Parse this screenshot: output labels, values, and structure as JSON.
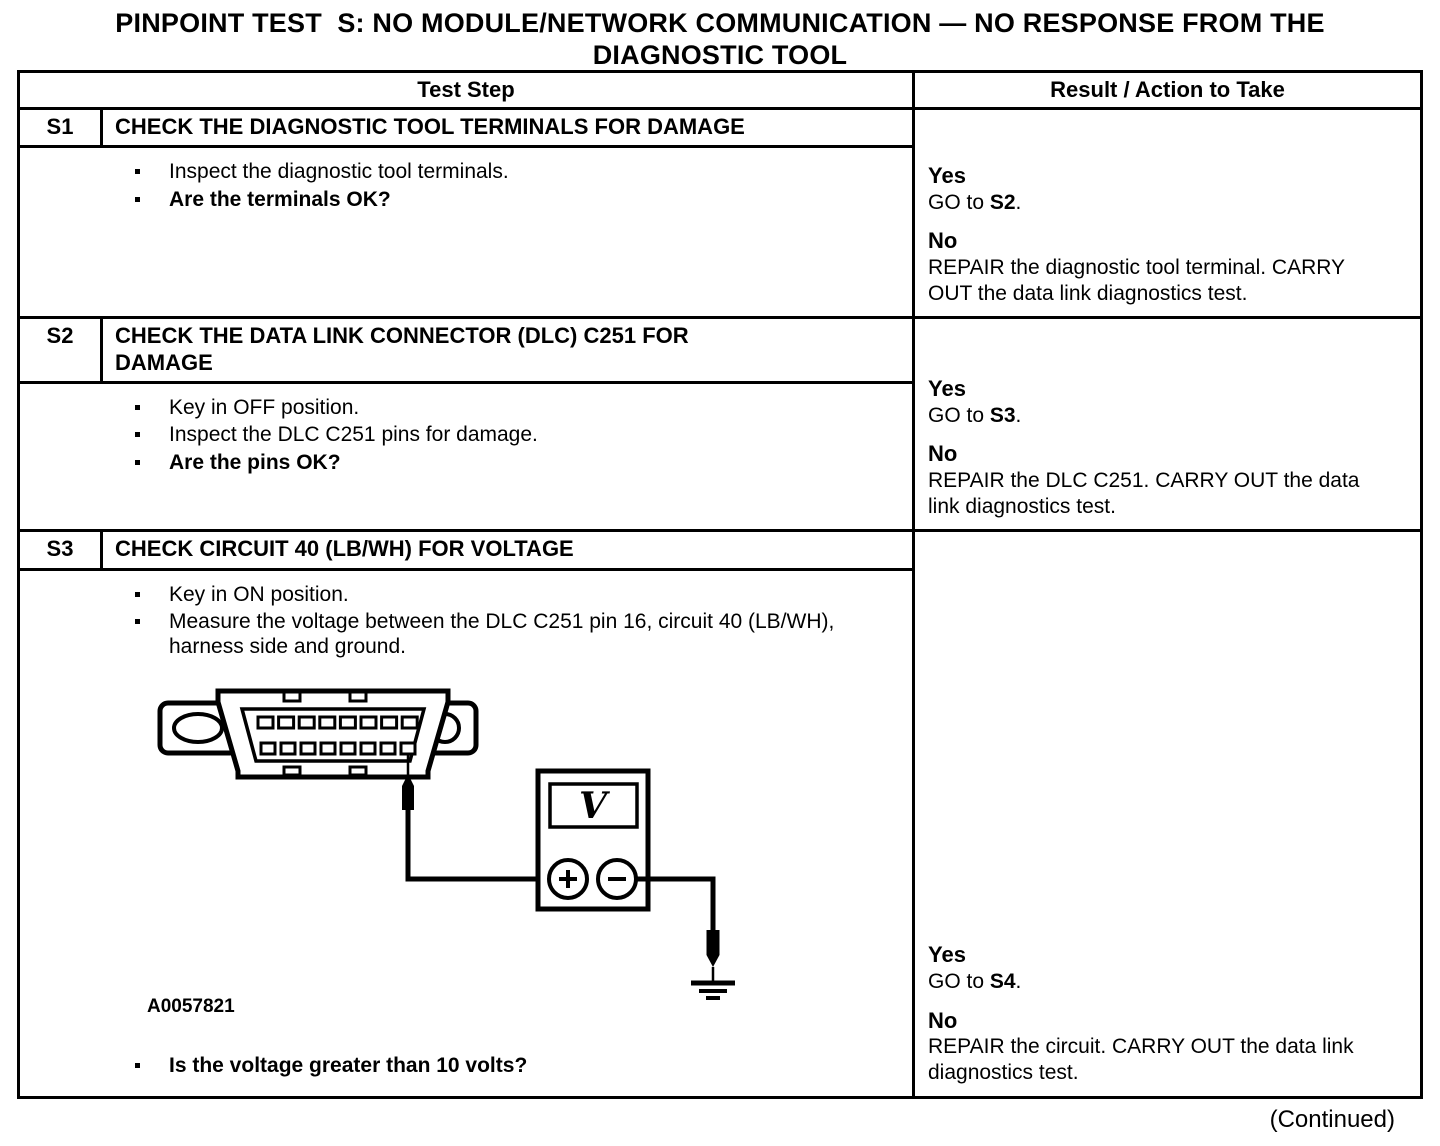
{
  "page": {
    "title_line1": "PINPOINT TEST  S: NO MODULE/NETWORK COMMUNICATION — NO RESPONSE FROM THE",
    "title_line2": "DIAGNOSTIC TOOL",
    "continued": "(Continued)"
  },
  "colors": {
    "ink": "#000000",
    "paper": "#ffffff"
  },
  "table": {
    "headers": {
      "test_step": "Test Step",
      "result": "Result / Action to Take"
    },
    "steps": [
      {
        "id": "S1",
        "title": "CHECK THE DIAGNOSTIC TOOL TERMINALS FOR DAMAGE",
        "bullets": [
          "Inspect the diagnostic tool terminals.",
          "Are the terminals OK?"
        ],
        "result": {
          "yes_label": "Yes",
          "go_prefix": "GO to ",
          "go_target": "S2",
          "go_suffix": ".",
          "no_label": "No",
          "no_action": "REPAIR the diagnostic tool terminal. CARRY OUT the data link diagnostics test."
        }
      },
      {
        "id": "S2",
        "title": "CHECK THE DATA LINK CONNECTOR (DLC) C251 FOR DAMAGE",
        "bullets": [
          "Key in OFF position.",
          "Inspect the DLC C251 pins for damage.",
          "Are the pins OK?"
        ],
        "result": {
          "yes_label": "Yes",
          "go_prefix": "GO to ",
          "go_target": "S3",
          "go_suffix": ".",
          "no_label": "No",
          "no_action": "REPAIR the DLC C251. CARRY OUT the data link diagnostics test."
        }
      },
      {
        "id": "S3",
        "title": "CHECK CIRCUIT 40 (LB/WH) FOR VOLTAGE",
        "bullets": [
          "Key in ON position.",
          "Measure the voltage between the DLC C251 pin 16, circuit 40 (LB/WH), harness side and ground."
        ],
        "figure": {
          "label": "A0057821",
          "voltmeter_display": "V"
        },
        "final_bullet": "Is the voltage greater than 10 volts?",
        "result": {
          "yes_label": "Yes",
          "go_prefix": "GO to ",
          "go_target": "S4",
          "go_suffix": ".",
          "no_label": "No",
          "no_action": "REPAIR the circuit. CARRY OUT the data link diagnostics test."
        }
      }
    ]
  }
}
